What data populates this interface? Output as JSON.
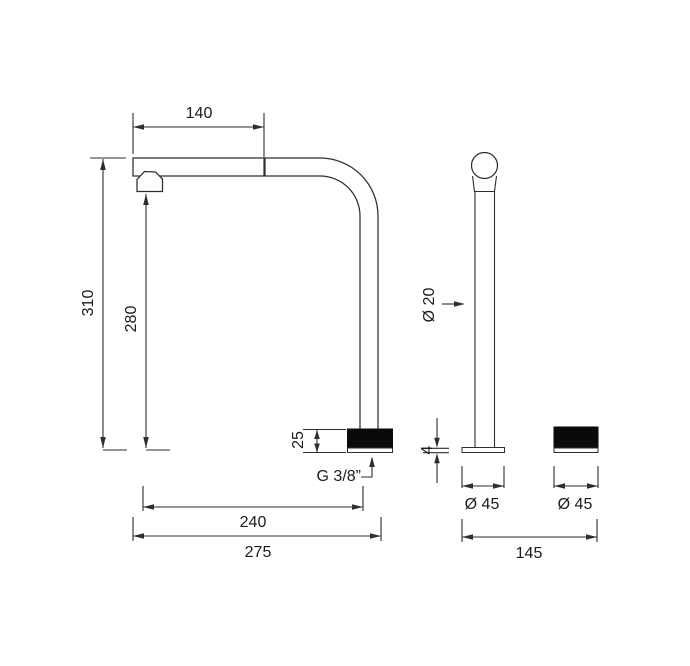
{
  "drawing": {
    "description": "Two-hole faucet technical dimension drawing: gooseneck spout side view and progressive control column side view",
    "colors": {
      "background": "#ffffff",
      "line": "#2e2e2e",
      "solid_fill": "#0a0a0a",
      "text": "#1b1b1b"
    },
    "labels": {
      "top_reach": "140",
      "total_height": "310",
      "clearance_height": "280",
      "base_height": "25",
      "thread": "G 3/8”",
      "reach_to_axis": "240",
      "overall_reach": "275",
      "column_diameter": "Ø 20",
      "plate_thickness": "4",
      "spout_base_diameter": "Ø 45",
      "control_base_diameter": "Ø 45",
      "hole_spacing": "145"
    },
    "dimensions_mm": [
      {
        "name": "top horizontal reach of spout",
        "value": "140"
      },
      {
        "name": "total spout height",
        "value": "310"
      },
      {
        "name": "height under aerator",
        "value": "280"
      },
      {
        "name": "spout base escutcheon height",
        "value": "25"
      },
      {
        "name": "supply thread",
        "value": "G 3/8”"
      },
      {
        "name": "reach to spout axis",
        "value": "240"
      },
      {
        "name": "overall reach",
        "value": "275"
      },
      {
        "name": "control column diameter",
        "value": "Ø 20"
      },
      {
        "name": "base plate thickness",
        "value": "4"
      },
      {
        "name": "spout escutcheon diameter",
        "value": "Ø 45"
      },
      {
        "name": "control escutcheon diameter",
        "value": "Ø 45"
      },
      {
        "name": "distance spout to control",
        "value": "145"
      }
    ]
  }
}
